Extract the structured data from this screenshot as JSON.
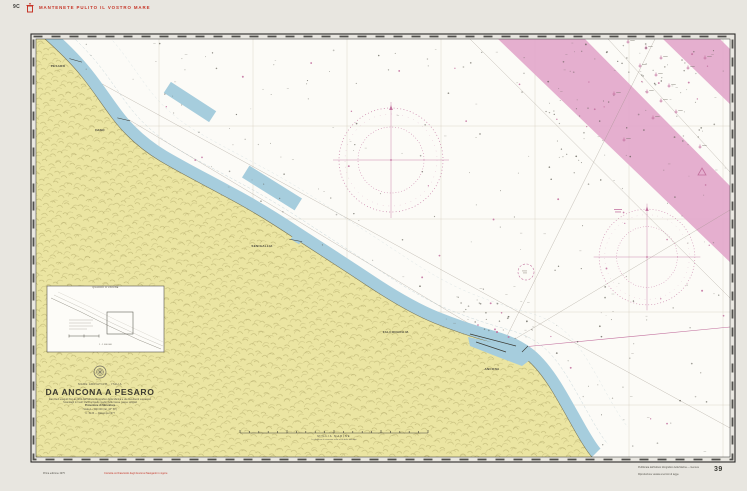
{
  "colors": {
    "paper": "#e8e6e0",
    "sea_white": "#fcfbf7",
    "land_yellow": "#ebe5a2",
    "shallow_blue": "#a6cddd",
    "traffic_band_pink": "#e2a6ca",
    "compass_magenta": "#c26f9d",
    "notice_red": "#c63527"
  },
  "header": {
    "code": "9C",
    "notice": "MANTENETE PULITO IL VOSTRO MARE"
  },
  "title_block": {
    "region": "MARE ADRIATICO - ITALIA",
    "title": "DA ANCONA A PESARO",
    "source": "Dai rilievi eseguiti fino al 1969 dall'Istituto Idrografico della Marina e da documenti successivi",
    "datum": "Scandagli in metri riferiti al livello medio delle basse maree sizigiali",
    "projection": "Proiezione di Mercatore",
    "scale": "Scala 1 : 100 000 (lat. 43° 50')",
    "edition": "I.I. 3133 — Ristampa 1977"
  },
  "ports": [
    {
      "name": "PESARO"
    },
    {
      "name": "FANO"
    },
    {
      "name": "SENIGALLIA"
    },
    {
      "name": "FALCONARA M."
    },
    {
      "name": "ANCONA"
    }
  ],
  "inset": {
    "title": "QUADRO D'UNIONE",
    "scale": "1 : 1 000 000"
  },
  "scale_bar": {
    "label": "MIGLIA MARINE",
    "note": "Le distanze si misurano sulla scala delle latitudini"
  },
  "margin": {
    "edition_note": "Prima edizione 1975",
    "correction_note": "Corretta col Fascicolo degli Avvisi ai Naviganti in vigore",
    "publisher_line1": "Pubblicata dall'Istituto Idrografico della Marina — Genova",
    "publisher_line2": "Riproduzione vietata a termini di legge",
    "chart_number": "39"
  }
}
